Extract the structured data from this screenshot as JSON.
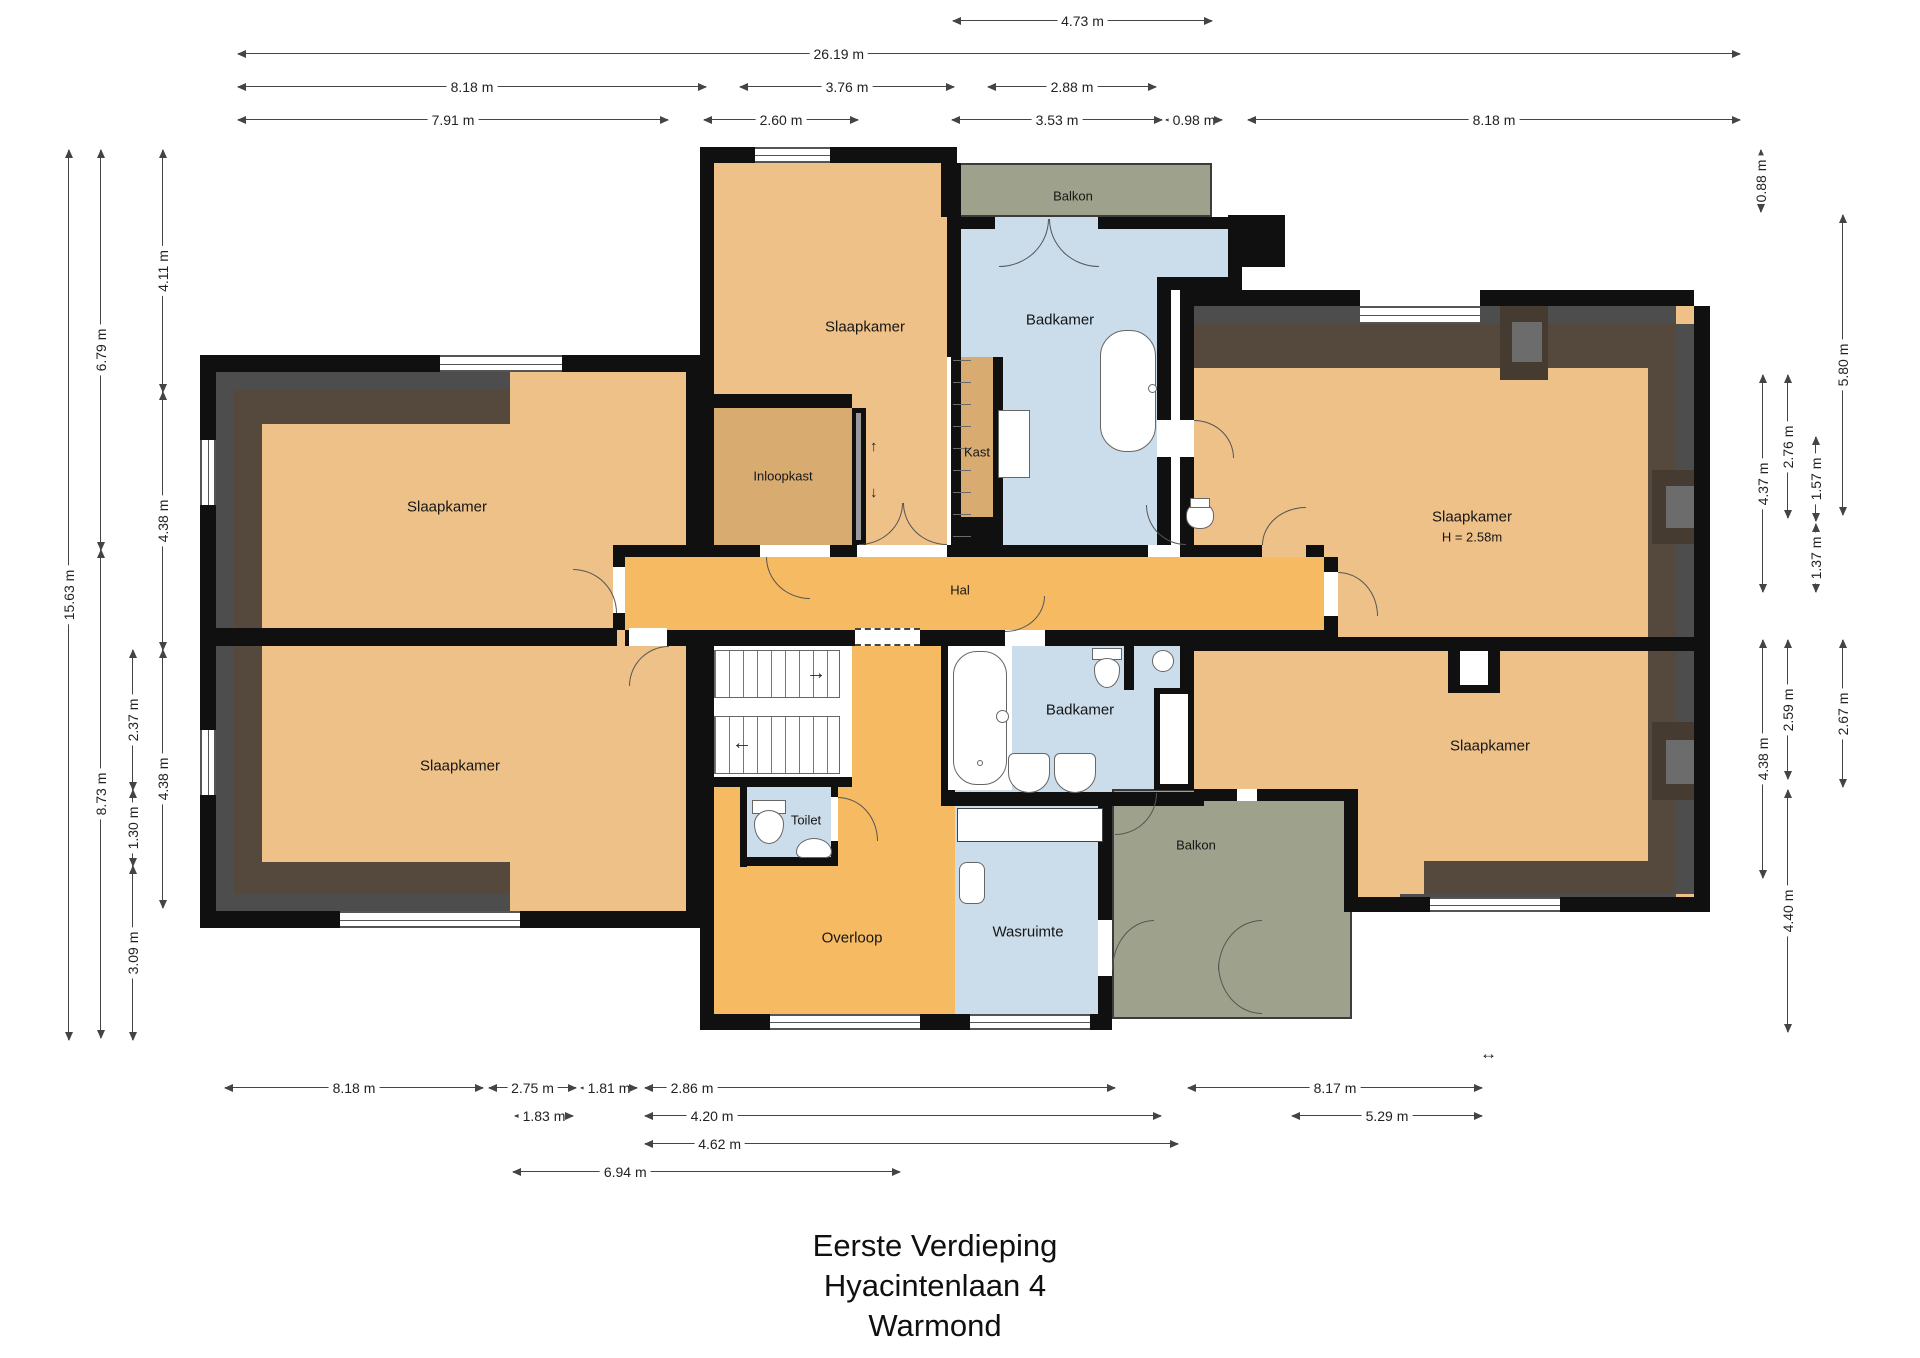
{
  "title": [
    "Eerste Verdieping",
    "Hyacintenlaan 4",
    "Warmond"
  ],
  "rooms": {
    "slaapkamer_tl": "Slaapkamer",
    "slaapkamer_bl": "Slaapkamer",
    "slaapkamer_tc": "Slaapkamer",
    "slaapkamer_tr": "Slaapkamer",
    "slaapkamer_tr_height": "H = 2.58m",
    "slaapkamer_br": "Slaapkamer",
    "inloopkast": "Inloopkast",
    "kast": "Kast",
    "badkamer_top": "Badkamer",
    "badkamer_bottom": "Badkamer",
    "hal": "Hal",
    "toilet": "Toilet",
    "overloop": "Overloop",
    "wasruimte": "Wasruimte",
    "balkon_top": "Balkon",
    "balkon_bottom": "Balkon"
  },
  "annotations": {
    "arrow_up": "↑",
    "arrow_down": "↓",
    "stair_arrow_right": "→",
    "stair_arrow_left": "←",
    "scale_marker": "↔"
  },
  "dimensions": {
    "top": [
      "4.73 m",
      "26.19 m",
      "8.18 m",
      "3.76 m",
      "2.88 m",
      "7.91 m",
      "2.60 m",
      "3.53 m",
      "0.98 m",
      "8.18 m"
    ],
    "bottom": [
      "8.18 m",
      "2.75 m",
      "1.81 m",
      "2.86 m",
      "8.17 m",
      "1.83 m",
      "4.20 m",
      "5.29 m",
      "4.62 m",
      "6.94 m"
    ],
    "left": [
      "15.63 m",
      "6.79 m",
      "8.73 m",
      "4.11 m",
      "4.38 m",
      "2.37 m",
      "1.30 m",
      "4.38 m",
      "3.09 m"
    ],
    "right": [
      "0.88 m",
      "5.80 m",
      "4.37 m",
      "2.76 m",
      "1.57 m",
      "1.37 m",
      "4.38 m",
      "2.59 m",
      "2.67 m",
      "4.40 m"
    ]
  },
  "colors": {
    "bedroom": "#eec189",
    "hall": "#f6ba62",
    "closet": "#d8ab71",
    "bathroom": "#cbdcea",
    "balcony": "#9ea28c",
    "wall": "#101010",
    "eaves_gray": "#4d4d4d",
    "eaves_brown": "#55493d"
  }
}
